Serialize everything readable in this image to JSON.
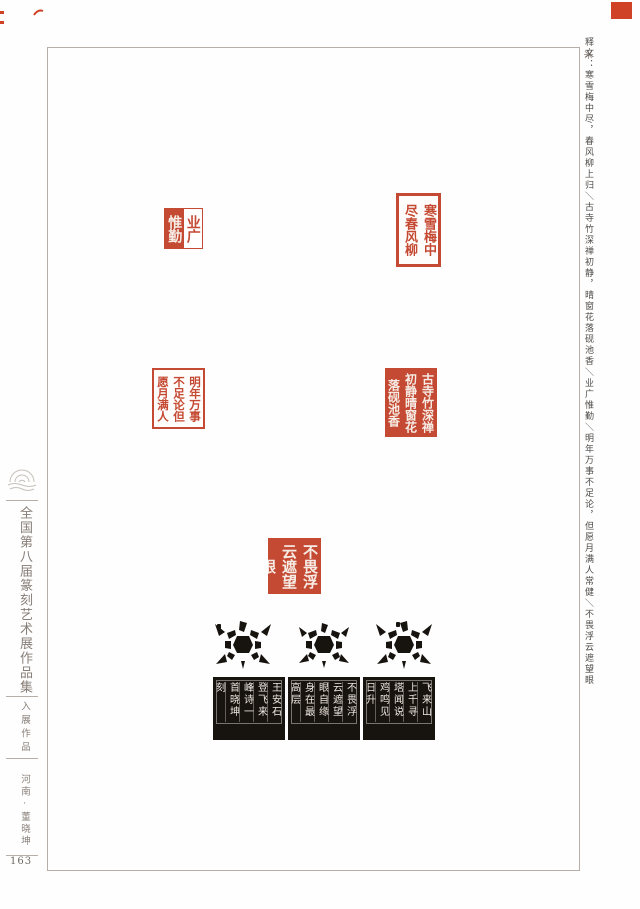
{
  "masthead": {
    "series_title": "全国第八届篆刻艺术展作品集",
    "section_label": "入展作品",
    "artist_display": "河南·董晓坤",
    "page_number": "163"
  },
  "annotation": {
    "text": "释文：寒雪梅中尽，春风柳上归＼古寺竹深禅初静，晴窗花落砚池香＼业广惟勤＼明年万事不足论，但愿月满人常健＼不畏浮云遮望眼"
  },
  "seals": [
    {
      "name": "seal-ye-guang-wei-qin",
      "inscription": "业广惟勤",
      "right_half": "业广",
      "left_half": "惟勤",
      "style": "朱白相间"
    },
    {
      "name": "seal-han-xue-mei",
      "inscription": "寒雪梅中尽春风柳上归",
      "style": "朱文"
    },
    {
      "name": "seal-ming-nian",
      "inscription": "明年万事不足论但愿月满人常健",
      "style": "朱文"
    },
    {
      "name": "seal-gu-si",
      "inscription": "古寺竹深禅初静晴窗花落砚池香",
      "style": "白文"
    },
    {
      "name": "seal-bu-wei",
      "inscription": "不畏浮云遮望眼",
      "style": "白文"
    }
  ],
  "rubbing": {
    "description": "龟钮边款拓片",
    "blocks": [
      {
        "position": "left",
        "columns": [
          "王安石",
          "登飞来",
          "峰诗一",
          "首晓坤",
          "刻"
        ]
      },
      {
        "position": "middle",
        "columns": [
          "不畏浮",
          "云遮望",
          "眼自缘",
          "身在最",
          "高层"
        ]
      },
      {
        "position": "right",
        "columns": [
          "飞来山",
          "上千寻",
          "塔闻说",
          "鸡鸣见",
          "日升"
        ]
      }
    ]
  },
  "colors": {
    "seal_red": "#c54a33",
    "corner_red": "#cf4226",
    "ink_black": "#17130f",
    "frame_gray": "#b7aea7",
    "text_gray": "#4e4b48",
    "title_gray": "#877e77"
  }
}
